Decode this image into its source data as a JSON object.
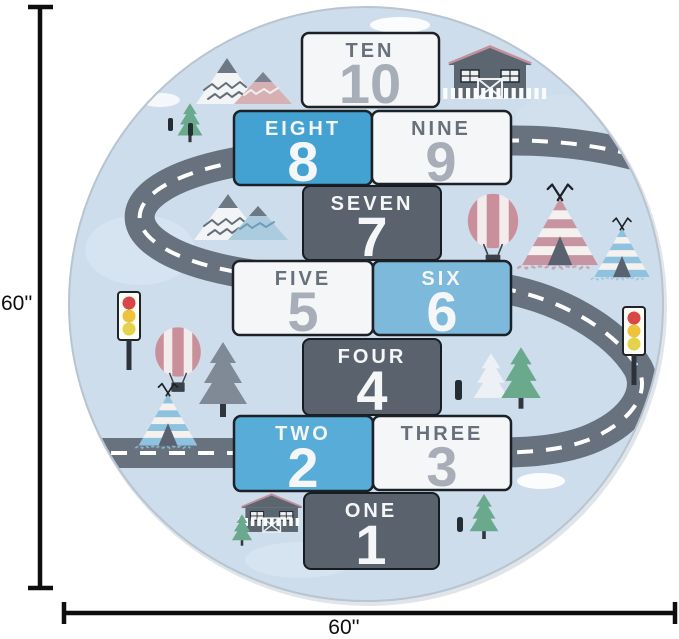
{
  "figure": {
    "type": "product dimension illustration",
    "subject": "round kids hopscotch & road play rug"
  },
  "dimensions": {
    "height_label": "60''",
    "width_label": "60''"
  },
  "rug": {
    "hopscotch": {
      "squares": [
        {
          "word": "TEN",
          "number": "10",
          "variant": "white"
        },
        {
          "word": "EIGHT",
          "number": "8",
          "variant": "blue"
        },
        {
          "word": "NINE",
          "number": "9",
          "variant": "white"
        },
        {
          "word": "SEVEN",
          "number": "7",
          "variant": "dark"
        },
        {
          "word": "FIVE",
          "number": "5",
          "variant": "white"
        },
        {
          "word": "SIX",
          "number": "6",
          "variant": "blue"
        },
        {
          "word": "FOUR",
          "number": "4",
          "variant": "dark"
        },
        {
          "word": "TWO",
          "number": "2",
          "variant": "blue"
        },
        {
          "word": "THREE",
          "number": "3",
          "variant": "white"
        },
        {
          "word": "ONE",
          "number": "1",
          "variant": "dark"
        }
      ]
    },
    "colors": {
      "background": "#cdddec",
      "road": "#68727e",
      "dark_square": "#59626d",
      "blue_square": "#44a2d3",
      "white_square": "#f4f6f8",
      "word_gray": "#68707c",
      "number_gray": "#a8aeb8",
      "border": "#1c2127",
      "accent_pink": "#c795a1",
      "accent_blue": "#8fc2de",
      "accent_green": "#6aa98b"
    },
    "decorations": [
      "winding-road",
      "mountains",
      "pine-trees",
      "barn-houses",
      "hot-air-balloons",
      "teepees",
      "traffic-lights",
      "white-fences",
      "clouds"
    ]
  }
}
